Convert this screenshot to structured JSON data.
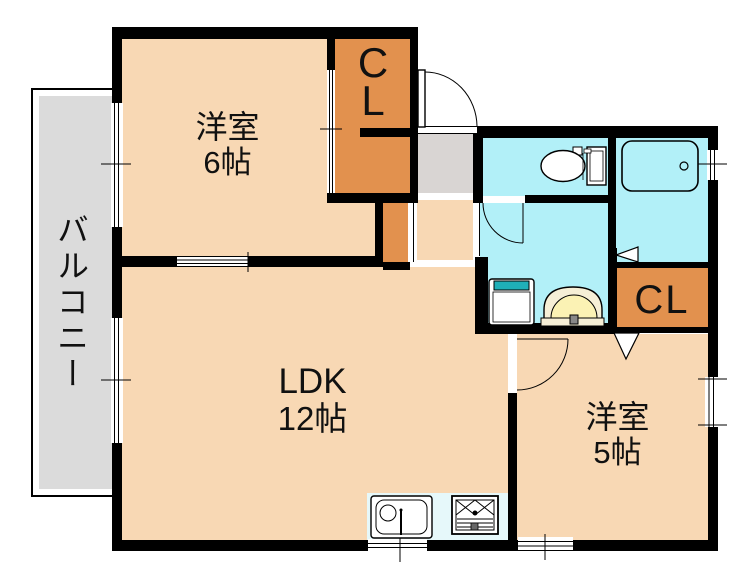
{
  "rooms": {
    "balcony": {
      "label": "バルコニー"
    },
    "bedroom6": {
      "name": "洋室",
      "size": "6帖"
    },
    "ldk": {
      "name": "LDK",
      "size": "12帖"
    },
    "bedroom5": {
      "name": "洋室",
      "size": "5帖"
    },
    "closet_main": {
      "letter1": "C",
      "letter2": "L"
    },
    "closet_bedroom5": {
      "label": "CL"
    }
  },
  "fixture_icons": [
    "toilet-icon",
    "bathtub-icon",
    "washbasin-icon",
    "washing-machine-icon",
    "kitchen-sink-icon",
    "gas-stove-icon",
    "entry-door-icon",
    "washroom-door-icon",
    "bedroom5-door-icon",
    "bath-folding-door-icon",
    "closet-bifold-door-icon",
    "sliding-door-icon",
    "window-icon"
  ],
  "colors": {
    "room-fill": "#F8D8B4",
    "closet-fill": "#E2914E",
    "wet-fill": "#B2F0F8",
    "kitchen-fill": "#E6F8FA",
    "balcony-fill": "#DBDBDB",
    "entry-fill": "#D9D5D3",
    "wall": "#000000",
    "basin-outer": "#F6EFD6",
    "basin-inner": "#FBF2B4",
    "washer-accent": "#1FAFB8",
    "text": "#111111"
  }
}
